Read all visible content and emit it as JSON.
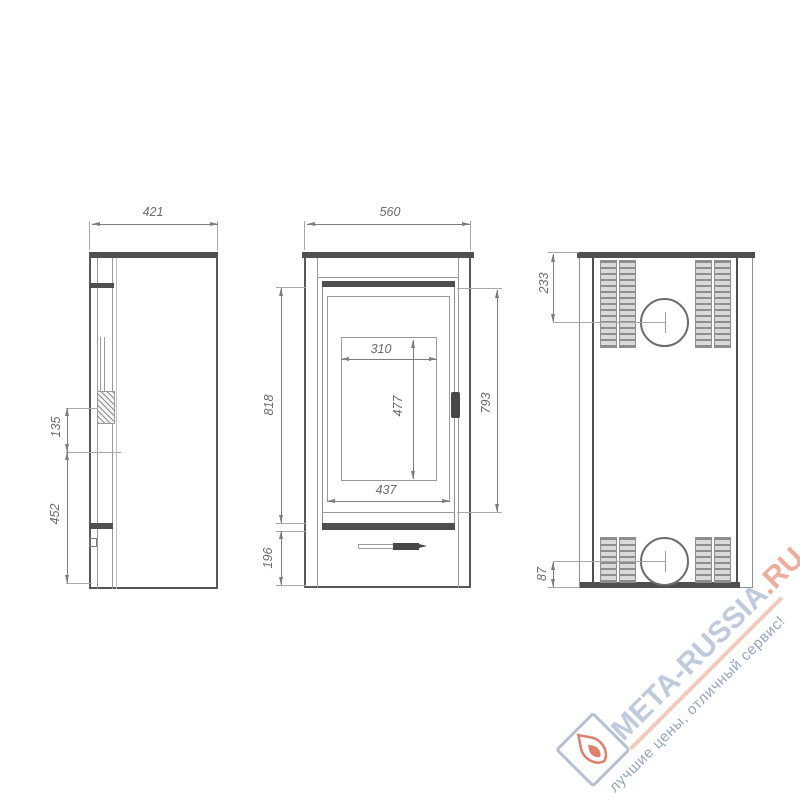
{
  "drawing": {
    "title": "stove-dimension-drawing",
    "side_view": {
      "overall_depth": "421",
      "handle_zone_height": "135",
      "handle_to_floor": "452"
    },
    "front_view": {
      "overall_width": "560",
      "glass_opening_width": "310",
      "glass_opening_height": "477",
      "glass_frame_width": "437",
      "door_zone_height": "793",
      "upper_body_height": "818",
      "plinth_height": "196"
    },
    "back_view": {
      "flue_center_from_top": "233",
      "flue_center_from_bottom": "87"
    }
  },
  "watermark": {
    "brand": "META-RUSSIA",
    "tld": ".RU",
    "slogan": "лучшие цены, отличный сервис!",
    "brand_color": "#b5c1d6",
    "tld_color": "#e9a28e",
    "underline_color": "#f0c4b0",
    "slogan_color": "#8095b3",
    "flame_color": "#d96a52",
    "logo_border_color": "#a9b6c9"
  }
}
